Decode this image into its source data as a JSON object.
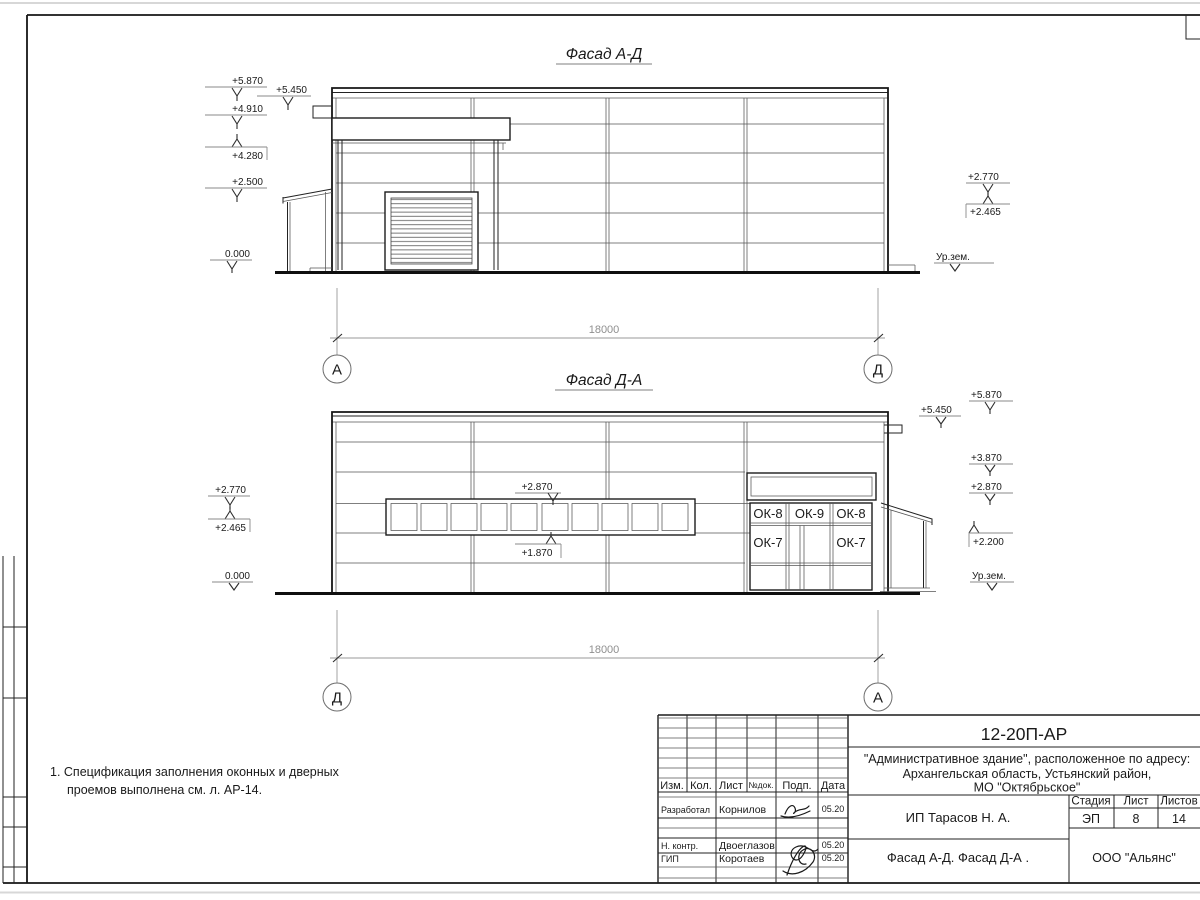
{
  "note": {
    "line1": "1. Спецификация заполнения оконных и дверных",
    "line2": "проемов выполнена см. л. АР-14."
  },
  "facade_top": {
    "title": "Фасад А-Д",
    "dim": "18000",
    "axis_left": "А",
    "axis_right": "Д",
    "lv_5870": "+5.870",
    "lv_4910": "+4.910",
    "lv_4280": "+4.280",
    "lv_2500": "+2.500",
    "lv_0000": "0.000",
    "lv_5450": "+5.450",
    "lv_2770": "+2.770",
    "lv_2465": "+2.465",
    "ground": "Ур.зем."
  },
  "facade_bottom": {
    "title": "Фасад Д-А",
    "dim": "18000",
    "axis_left": "Д",
    "axis_right": "А",
    "lv_5870": "+5.870",
    "lv_5450": "+5.450",
    "lv_3870": "+3.870",
    "lv_2870": "+2.870",
    "lv_2200": "+2.200",
    "ground_right": "Ур.зем.",
    "lv_2770": "+2.770",
    "lv_2465": "+2.465",
    "lv_0000": "0.000",
    "band_top": "+2.870",
    "band_bottom": "+1.870",
    "win_ok8_left": "ОК-8",
    "win_ok9": "ОК-9",
    "win_ok8_right": "ОК-8",
    "win_ok7_left": "ОК-7",
    "win_ok7_right": "ОК-7"
  },
  "title_block": {
    "code": "12-20П-АР",
    "project_line1": "\"Административное здание\", расположенное по адресу:",
    "project_line2": "Архангельская область, Устьянский район,",
    "project_line3": "МО \"Октябрьское\"",
    "col_izm": "Изм.",
    "col_kol": "Кол.",
    "col_list": "Лист",
    "col_ndok": "№док.",
    "col_podp": "Подп.",
    "col_data": "Дата",
    "role_dev": "Разработал",
    "name_dev": "Корнилов",
    "date_dev": "05.20",
    "role_ncontr": "Н. контр.",
    "name_ncontr": "Двоеглазов",
    "date_ncontr": "05.20",
    "role_gip": "ГИП",
    "name_gip": "Коротаев",
    "date_gip": "05.20",
    "client": "ИП Тарасов Н. А.",
    "sheet_name": "Фасад А-Д. Фасад Д-А .",
    "stage_label": "Стадия",
    "list_label": "Лист",
    "listov_label": "Листов",
    "stage": "ЭП",
    "list_num": "8",
    "listov_num": "14",
    "company": "ООО \"Альянс\""
  }
}
